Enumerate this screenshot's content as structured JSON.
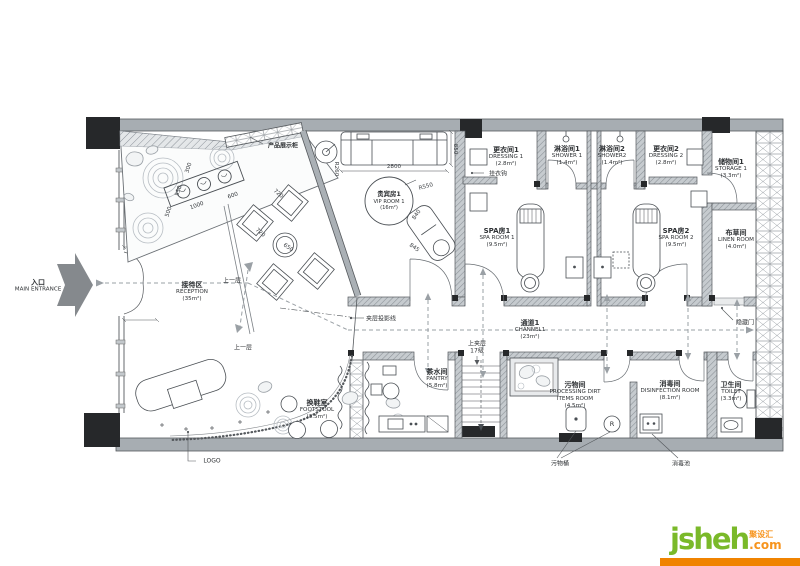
{
  "entrance": {
    "zh": "入口",
    "en": "MAIN ENTRANCE"
  },
  "rooms": {
    "reception": {
      "zh": "接待区",
      "en": "RECEPTION",
      "area": "(35m²)"
    },
    "vip": {
      "zh": "贵宾房1",
      "en": "VIP ROOM 1",
      "area": "(16m²)"
    },
    "dressing1": {
      "zh": "更衣间1",
      "en": "DRESSING 1",
      "area": "(2.8m²)"
    },
    "shower1": {
      "zh": "淋浴间1",
      "en": "SHOWER 1",
      "area": "(1.4m²)"
    },
    "shower2": {
      "zh": "淋浴间2",
      "en": "SHOWER2",
      "area": "(1.4m²)"
    },
    "dressing2": {
      "zh": "更衣间2",
      "en": "DRESSING 2",
      "area": "(2.8m²)"
    },
    "storage1": {
      "zh": "储物间1",
      "en": "STORAGE 1",
      "area": "(3.3m²)"
    },
    "spa1": {
      "zh": "SPA房1",
      "en": "SPA ROOM 1",
      "area": "(9.5m²)"
    },
    "spa2": {
      "zh": "SPA房2",
      "en": "SPA ROOM 2",
      "area": "(9.5m²)"
    },
    "linen": {
      "zh": "布草间",
      "en": "LINEN ROOM",
      "area": "(4.0m²)"
    },
    "channel1": {
      "zh": "通道1",
      "en": "CHANNEL1",
      "area": "(23m²)"
    },
    "footstool": {
      "zh": "换鞋室",
      "en": "FOOTSTOOL",
      "area": "(3.5m²)"
    },
    "pantry": {
      "zh": "茶水间",
      "en": "PANTRY",
      "area": "(5.8m²)"
    },
    "dirt": {
      "zh": "污物间",
      "en1": "PROCESSING DIRT",
      "en2": "ITEMS ROOM",
      "area": "(4.5m²)"
    },
    "disinfection": {
      "zh": "消毒间",
      "en": "DISINFECTION ROOM",
      "area": "(8.1m²)"
    },
    "toilet": {
      "zh": "卫生间",
      "en": "TOILET",
      "area": "(3.3m²)"
    }
  },
  "annotations": {
    "product_display": "产品展示柜",
    "coat_hook": "挂衣钩",
    "mezzanine_projection": "夹层投影线",
    "up_mezzanine": "上夹层",
    "mezzanine_steps": "17级",
    "hidden_door": "隐藏门",
    "dirt_bucket": "污物桶",
    "disinfection_pool": "消毒池",
    "logo_note": "LOGO",
    "up_one_level": "上一层",
    "radius_mark": "R"
  },
  "dimensions": {
    "sofa_width": "2800",
    "sofa_depth": "850",
    "vip_radius": "R550",
    "table_radius": "R260",
    "lounge_width": "840",
    "lounge_length": "845",
    "display_length": "1000",
    "display_width": "600",
    "garden_300": "300",
    "garden_550": "550",
    "garden_500": "500",
    "seat_720_a": "720",
    "seat_720_b": "720",
    "round_table": "650"
  },
  "watermark": {
    "name": "jsheh",
    "tld": ".com",
    "cn": "聚设汇"
  },
  "colors": {
    "logo_green": "#7ab929",
    "logo_orange": "#f7941d",
    "bar_orange": "#f08300",
    "wall_gray": "#aab0b5",
    "line_dark": "#4a4f54",
    "arrow_gray": "#9aa0a5"
  }
}
